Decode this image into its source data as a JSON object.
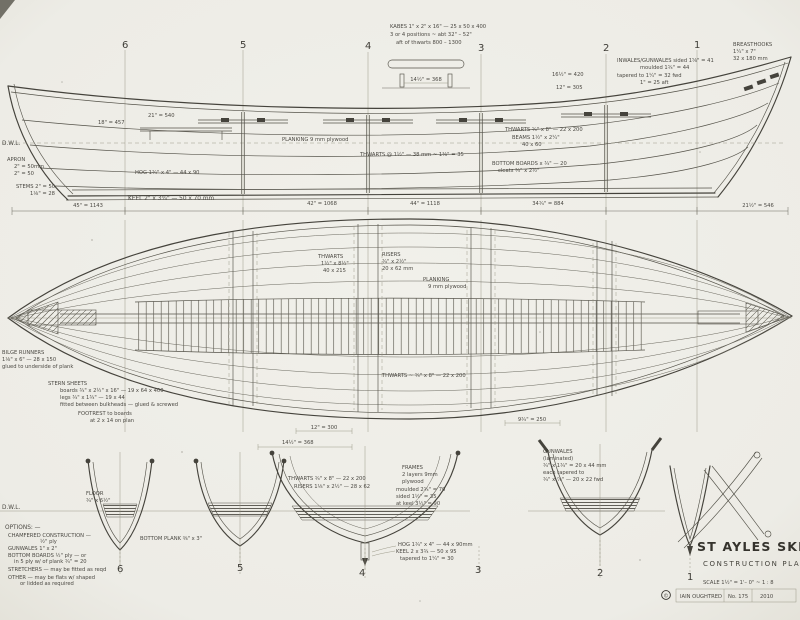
{
  "sheet": {
    "background": "#efeee8",
    "ink": "#45433c",
    "faded_ink": "#93917f"
  },
  "stations_top": [
    "6",
    "5",
    "4",
    "3",
    "2",
    "1"
  ],
  "stations_bottom": [
    "6",
    "5",
    "4",
    "3",
    "2",
    "1"
  ],
  "profile": {
    "dwl": "D.W.L.",
    "oar_note_1": "KABES 1\" x 2\" x 16\" — 25 x 50 x 400",
    "oar_note_2": "3 or 4 positions ~ abt 32\" – 52\"",
    "oar_note_3": "aft of thwarts        800 – 1300",
    "detail_dim": "14½\" = 368",
    "breasthooks_1": "BREASTHOOKS",
    "breasthooks_2": "1¼\" x 7\"",
    "breasthooks_3": "32 x 180 mm",
    "inwales_1": "INWALES/GUNWALES  sided 1⅝\" = 41",
    "inwales_2": "moulded 1¾\" = 44",
    "inwales_3": "tapered to 1¼\" = 32  fwd",
    "inwales_4": "1\" = 25  aft",
    "dim_a": "16½\" = 420",
    "dim_b": "12\" = 305",
    "dim_c": "21\" = 540",
    "dim_d": "18\" = 457",
    "apron_1": "APRON",
    "apron_2": "2\" = 50mm",
    "apron_3": "2\" = 50",
    "stems_1": "STEMS  2\" = 50",
    "stems_2": "1⅛\" = 28",
    "hog": "HOG 1¾\" x 4\" — 44 x 90",
    "keel": "KEEL   2\" x 3¾\" — 50 x 70 mm",
    "planking": "PLANKING   9 mm plywood",
    "thwarts_note": "THWARTS @ 1½\" — 38 mm   ~  1⅜\" = 35",
    "thwart_dim": "THWARTS  ¾\" x 8\" — 22 x 200",
    "beams_1": "BEAMS 1½\" x 2¼\"",
    "beams_2": "40 x 60",
    "bottom_boards_1": "BOTTOM BOARDS  x ¾\" — 20",
    "bottom_boards_2": "cleats ¾\" x 2½\""
  },
  "dims": {
    "d1": "45\" = 1143",
    "d2": "42\" = 1068",
    "d3": "44\" = 1118",
    "d4": "34¾\" = 884",
    "d5": "21½\" = 546"
  },
  "plan": {
    "thwart_1": "THWARTS",
    "thwart_2": "1½\" x 8½\"",
    "thwart_3": "40 x 215",
    "risers_1": "RISERS",
    "risers_2": "¾\" x 2½\"",
    "risers_3": "20 x 62 mm",
    "planking_1": "PLANKING",
    "planking_2": "9 mm plywood",
    "thwarts_note": "THWARTS ~ ¾\" x 8\" — 22 x 200",
    "bilge_1": "BILGE RUNNERS",
    "bilge_2": "1⅛\" x 6\" — 28 x 150",
    "bilge_3": "glued to underside of plank",
    "stern_1": "STERN SHEETS",
    "stern_2": "boards ¾\" x 2½\" x 16\" — 19 x 64 x 400",
    "stern_3": "legs ¾\" x 1¾\" — 19 x 44",
    "stern_4": "fitted between bulkheads — glued & screwed",
    "footrest_1": "FOOTREST   to boards",
    "footrest_2": "at 2 x 14 on plan",
    "dim_a": "12\" = 300",
    "dim_b": "9¾\" = 250"
  },
  "sections": {
    "dwl": "D.W.L.",
    "dim_top": "14½\" = 368",
    "thwarts": "THWARTS  ¾\" x 8\" — 22 x 200",
    "risers": "RISERS  1⅛\" x 2½\" — 28 x 62",
    "frames_1": "FRAMES",
    "frames_2": "2 layers 9mm",
    "frames_3": "plywood",
    "frames_4": "moulded 2¾\" = 70",
    "frames_5": "sided 1½\" = 35",
    "frames_6": "at keel 3½\" = 90",
    "hog": "HOG 1¾\" x 4\" — 44 x 90mm",
    "keel_1": "KEEL 2 x 3¾ — 50 x 95",
    "keel_2": "tapered to 1¼\" = 30",
    "gunwales_1": "GUNWALES",
    "gunwales_2": "(laminated)",
    "gunwales_3": "¾\" x 1¾\" = 20 x 44 mm",
    "gunwales_4": "each tapered to",
    "gunwales_5": "¾\" x ⅞\" — 20 x 22  fwd",
    "floor_1": "FLOOR",
    "floor_2": "¾\" x 6½\"",
    "bottom_plank": "BOTTOM PLANK  ⅜\" x 3\""
  },
  "options": {
    "heading": "OPTIONS: —",
    "o1": "CHAMFERED CONSTRUCTION —",
    "o2": "½\" ply",
    "o3": "GUNWALES  1\" x 2\"",
    "o4": "BOTTOM BOARDS  ½\" ply — or",
    "o5": "in 5 ply w/ of plank ¾\" = 20",
    "o6": "STRETCHERS — may be fitted as reqd",
    "o7": "OTHER — may be flats w/ shaped",
    "o8": "or lidded as required"
  },
  "title_block": {
    "title": "ST AYLES SKIFF",
    "subtitle": "CONSTRUCTION PLAN",
    "scale": "SCALE  1½\" = 1'– 0\"   ~   1 : 8",
    "copyright": "©",
    "credit": "IAIN OUGHTRED",
    "sheet": "No. 175",
    "year": "2010"
  }
}
